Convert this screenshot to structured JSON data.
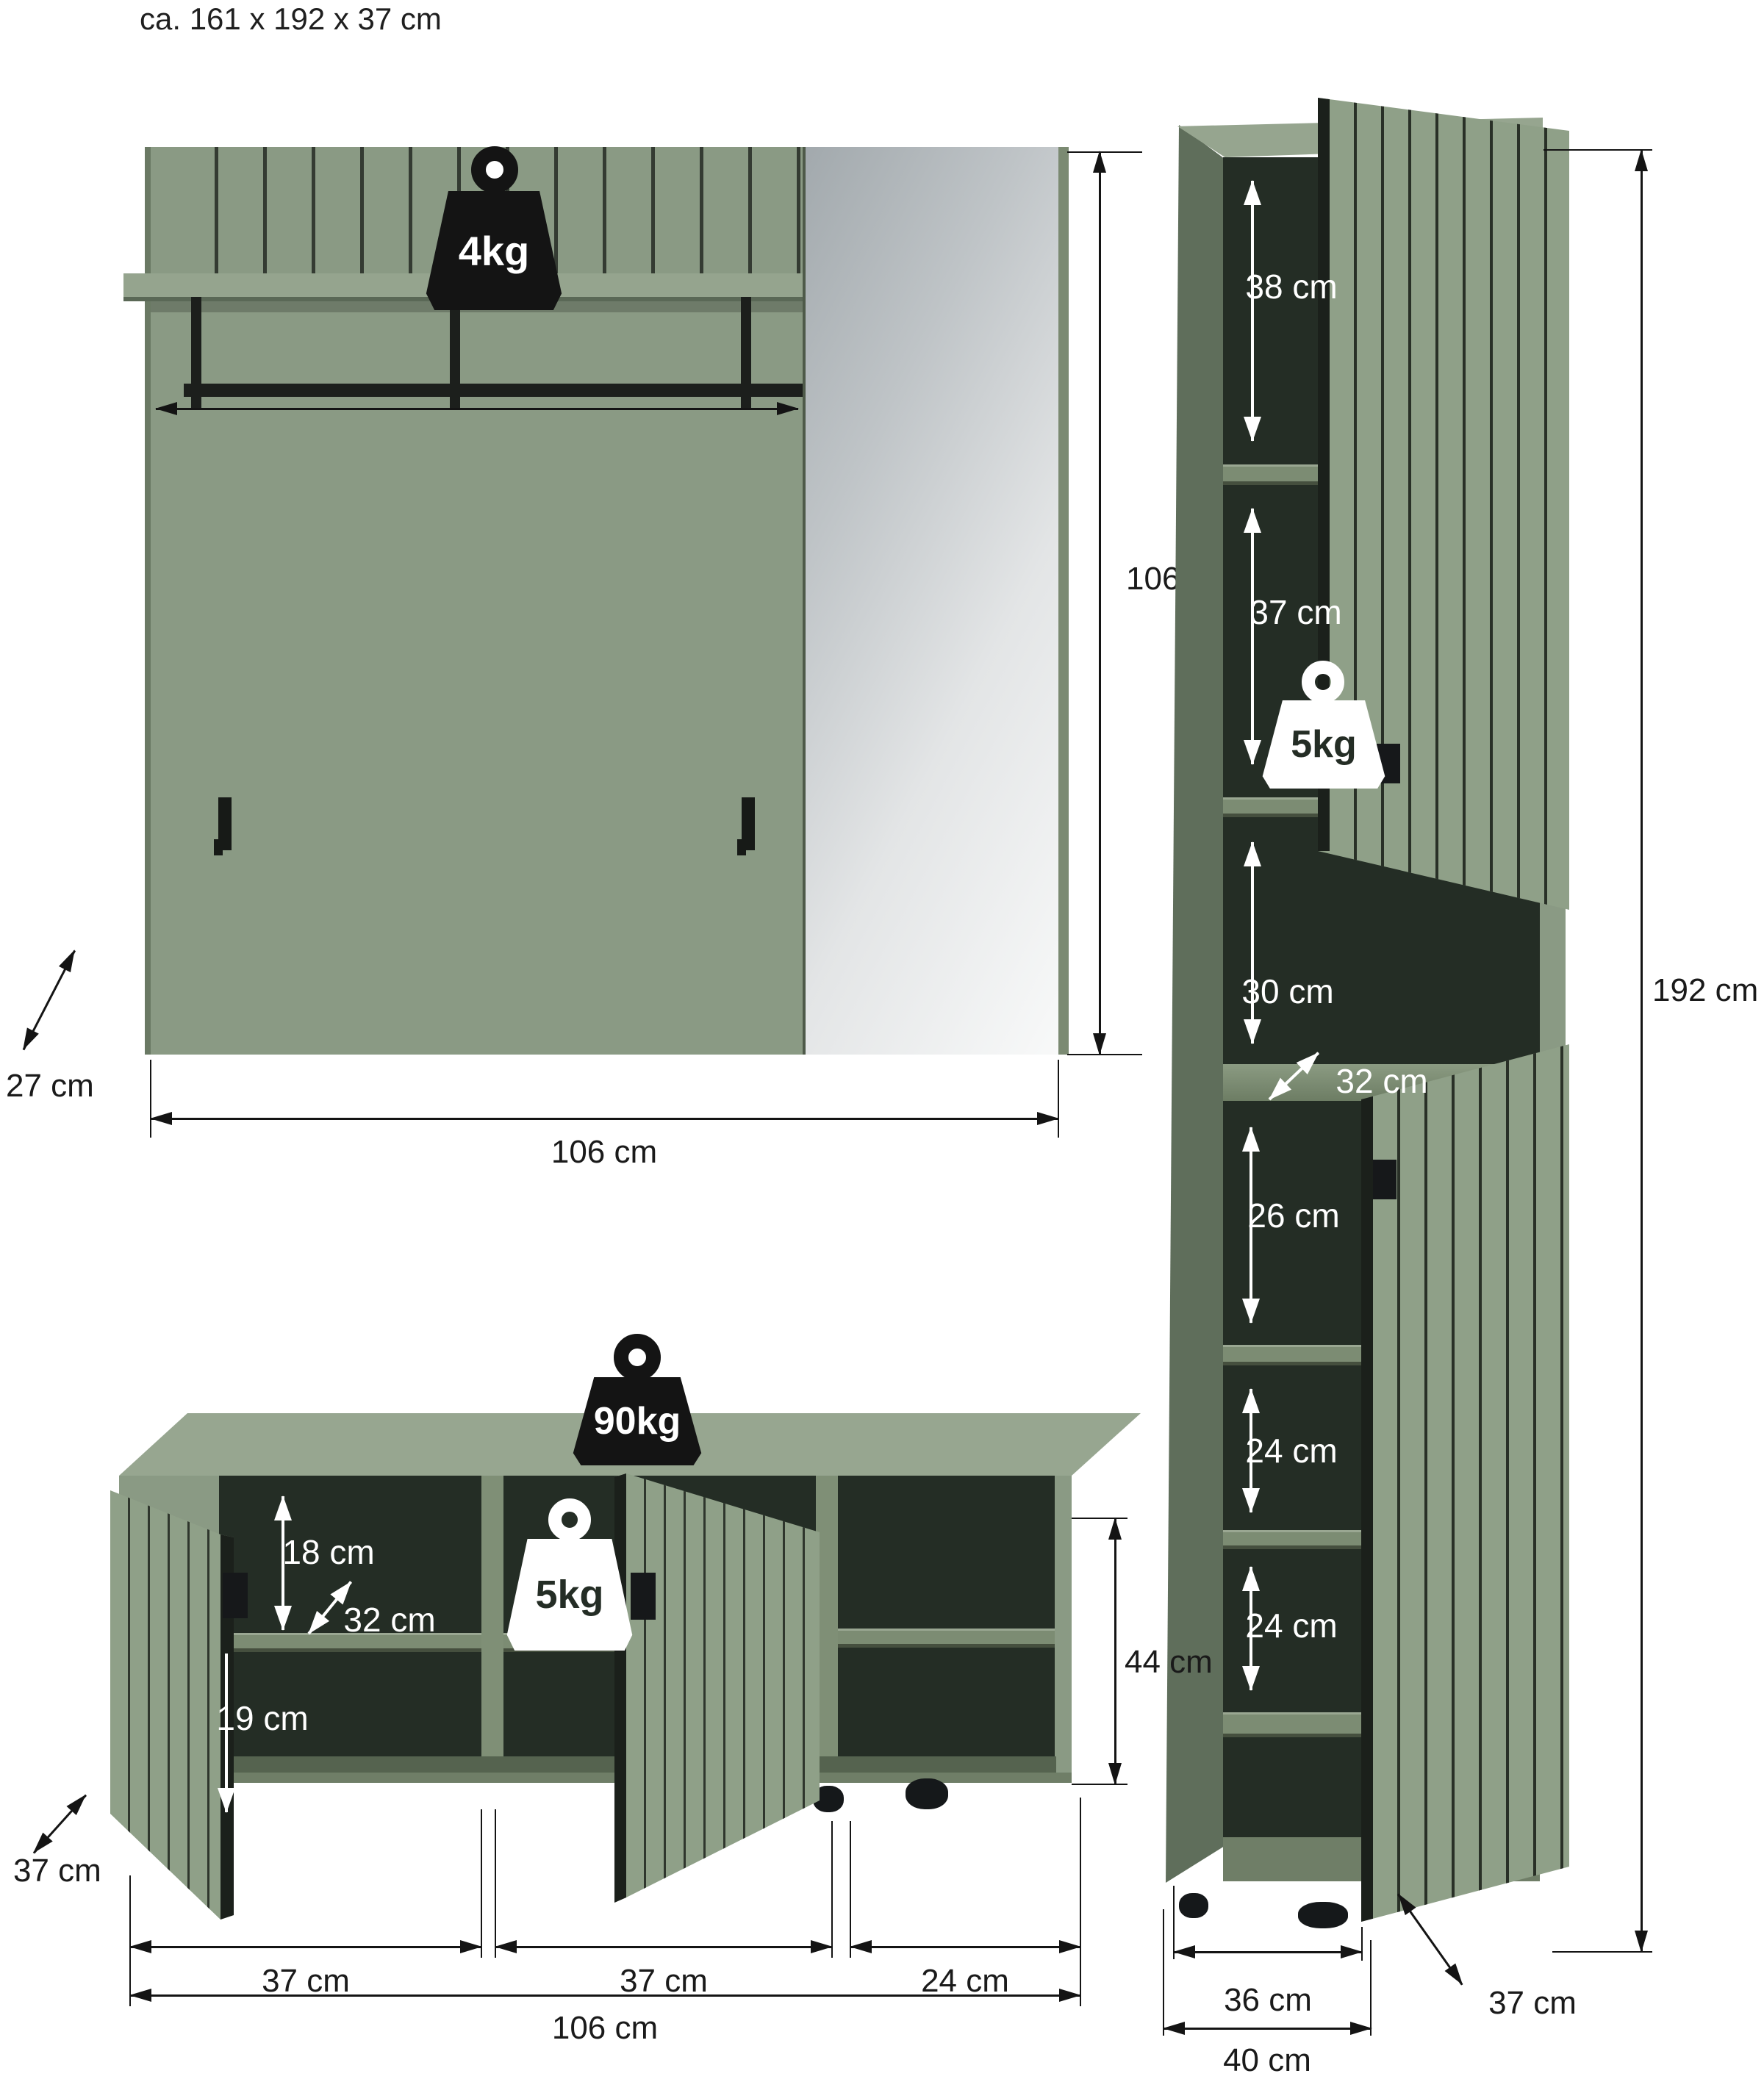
{
  "title": "ca. 161 x 192 x 37 cm",
  "colors": {
    "furniture_green": "#8a9a84",
    "furniture_green_dark": "#5f6e5b",
    "interior_dark": "#242d25",
    "annotation_black": "#141414",
    "annotation_white": "#ffffff"
  },
  "panel": {
    "weight_badge": "4kg",
    "width_label": "106 cm",
    "height_label": "106 cm",
    "depth_label": "27 cm"
  },
  "column": {
    "height_label": "192 cm",
    "inner_width_label": "36 cm",
    "outer_width_label": "40 cm",
    "depth_label": "37 cm",
    "shelf_weight_badge": "5kg",
    "niche_depth_label": "32 cm",
    "compartments": [
      {
        "label": "38 cm"
      },
      {
        "label": "37 cm"
      },
      {
        "label": "30 cm"
      },
      {
        "label": "26 cm"
      },
      {
        "label": "24 cm"
      },
      {
        "label": "24 cm"
      }
    ]
  },
  "bench": {
    "top_weight_badge": "90kg",
    "shelf_weight_badge": "5kg",
    "upper_inner_height_label": "18 cm",
    "inner_depth_label": "32 cm",
    "lower_inner_height_label": "19 cm",
    "section_width_labels": [
      "37 cm",
      "37 cm",
      "24 cm"
    ],
    "total_width_label": "106 cm",
    "height_label": "44 cm",
    "depth_label": "37 cm"
  }
}
